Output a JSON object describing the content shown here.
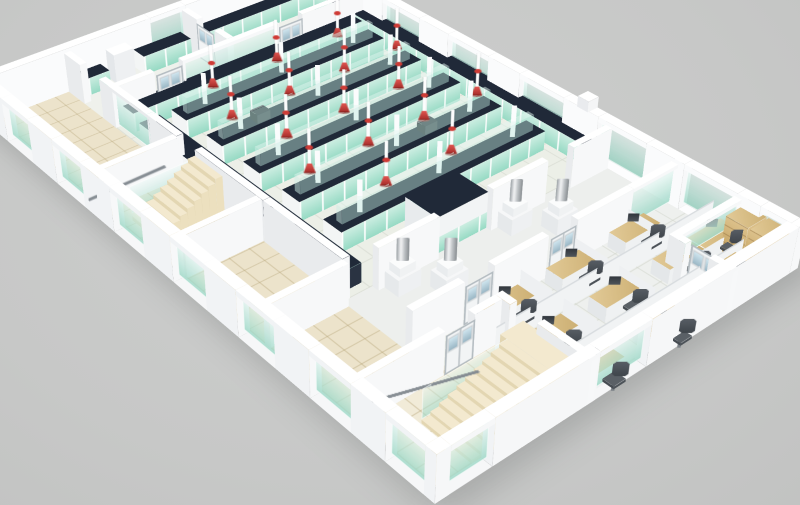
{
  "page_title": "3D Laboratory Floor Plan Rendering",
  "scene_label": "Isometric 3D cutaway rendering of a single-floor laboratory: central lab hall with five island benches, teal cabinets, dark countertops and red ceiling-mounted fume extractor arms; glass-walled perimeter rooms; office cubicle area with desks and chairs; corner office with wooden bookshelves; two staircases; white walls with teal glass window panels on a gray background",
  "palette": {
    "background_hi": "#cdcecd",
    "background_md": "#c7c8c7",
    "background_lo": "#c2c3c2",
    "wall_top": "#ffffff",
    "wall_se": "#f7f8f9",
    "wall_sw": "#e9ebed",
    "wall_out": "#f1f3f5",
    "glass_lo": "rgba(158,216,199,0.85)",
    "glass_hi": "rgba(238,250,247,0.55)",
    "floor_main": "#edefe9",
    "floor_lab": "#ecefe7",
    "floor_beige": "#ece3cb",
    "floor_office": "#eef0ee",
    "tile_line_beige": "rgba(178,160,114,0.45)",
    "tile_line_main": "rgba(208,212,202,0.65)",
    "bench_top": "#202938",
    "bench_teal": "#96dac4",
    "bench_teal_hi": "#cdeee2",
    "bench_white": "#f3f5f5",
    "riser_top": "rgba(225,245,240,0.5)",
    "riser_face": "rgba(190,232,222,0.45)",
    "red": "#cf3b35",
    "red_hi": "#e25550",
    "red_lo": "#a42e2a",
    "steel_hi": "#f5f6f7",
    "steel_lo": "#878c90",
    "wood_hi": "#dcc18b",
    "wood_lo": "#c2a05f",
    "chair": "#4e545a",
    "stair": "#f3e9cf",
    "stair_riser": "#e3d6b2",
    "stair_side": "#ece0bf",
    "rail": "#868d93",
    "door": "#f2f4f5",
    "door_frame": "#b4bcc1",
    "shadow": "rgba(60,64,66,0.22)"
  },
  "inventory": {
    "lab_island_benches": 5,
    "perimeter_benches": 6,
    "fume_extractor_arms": 16,
    "fume_hood_vents": 4,
    "central_service_block": 1,
    "service_columns": 15,
    "office_desks": 10,
    "office_chairs": 10,
    "monitors": 9,
    "bookshelf_cabinets": 2,
    "staircases": 2,
    "doors": 8,
    "glass_wall_panels": 20,
    "empty_tiled_rooms": 4,
    "wall_pilasters": 3
  }
}
